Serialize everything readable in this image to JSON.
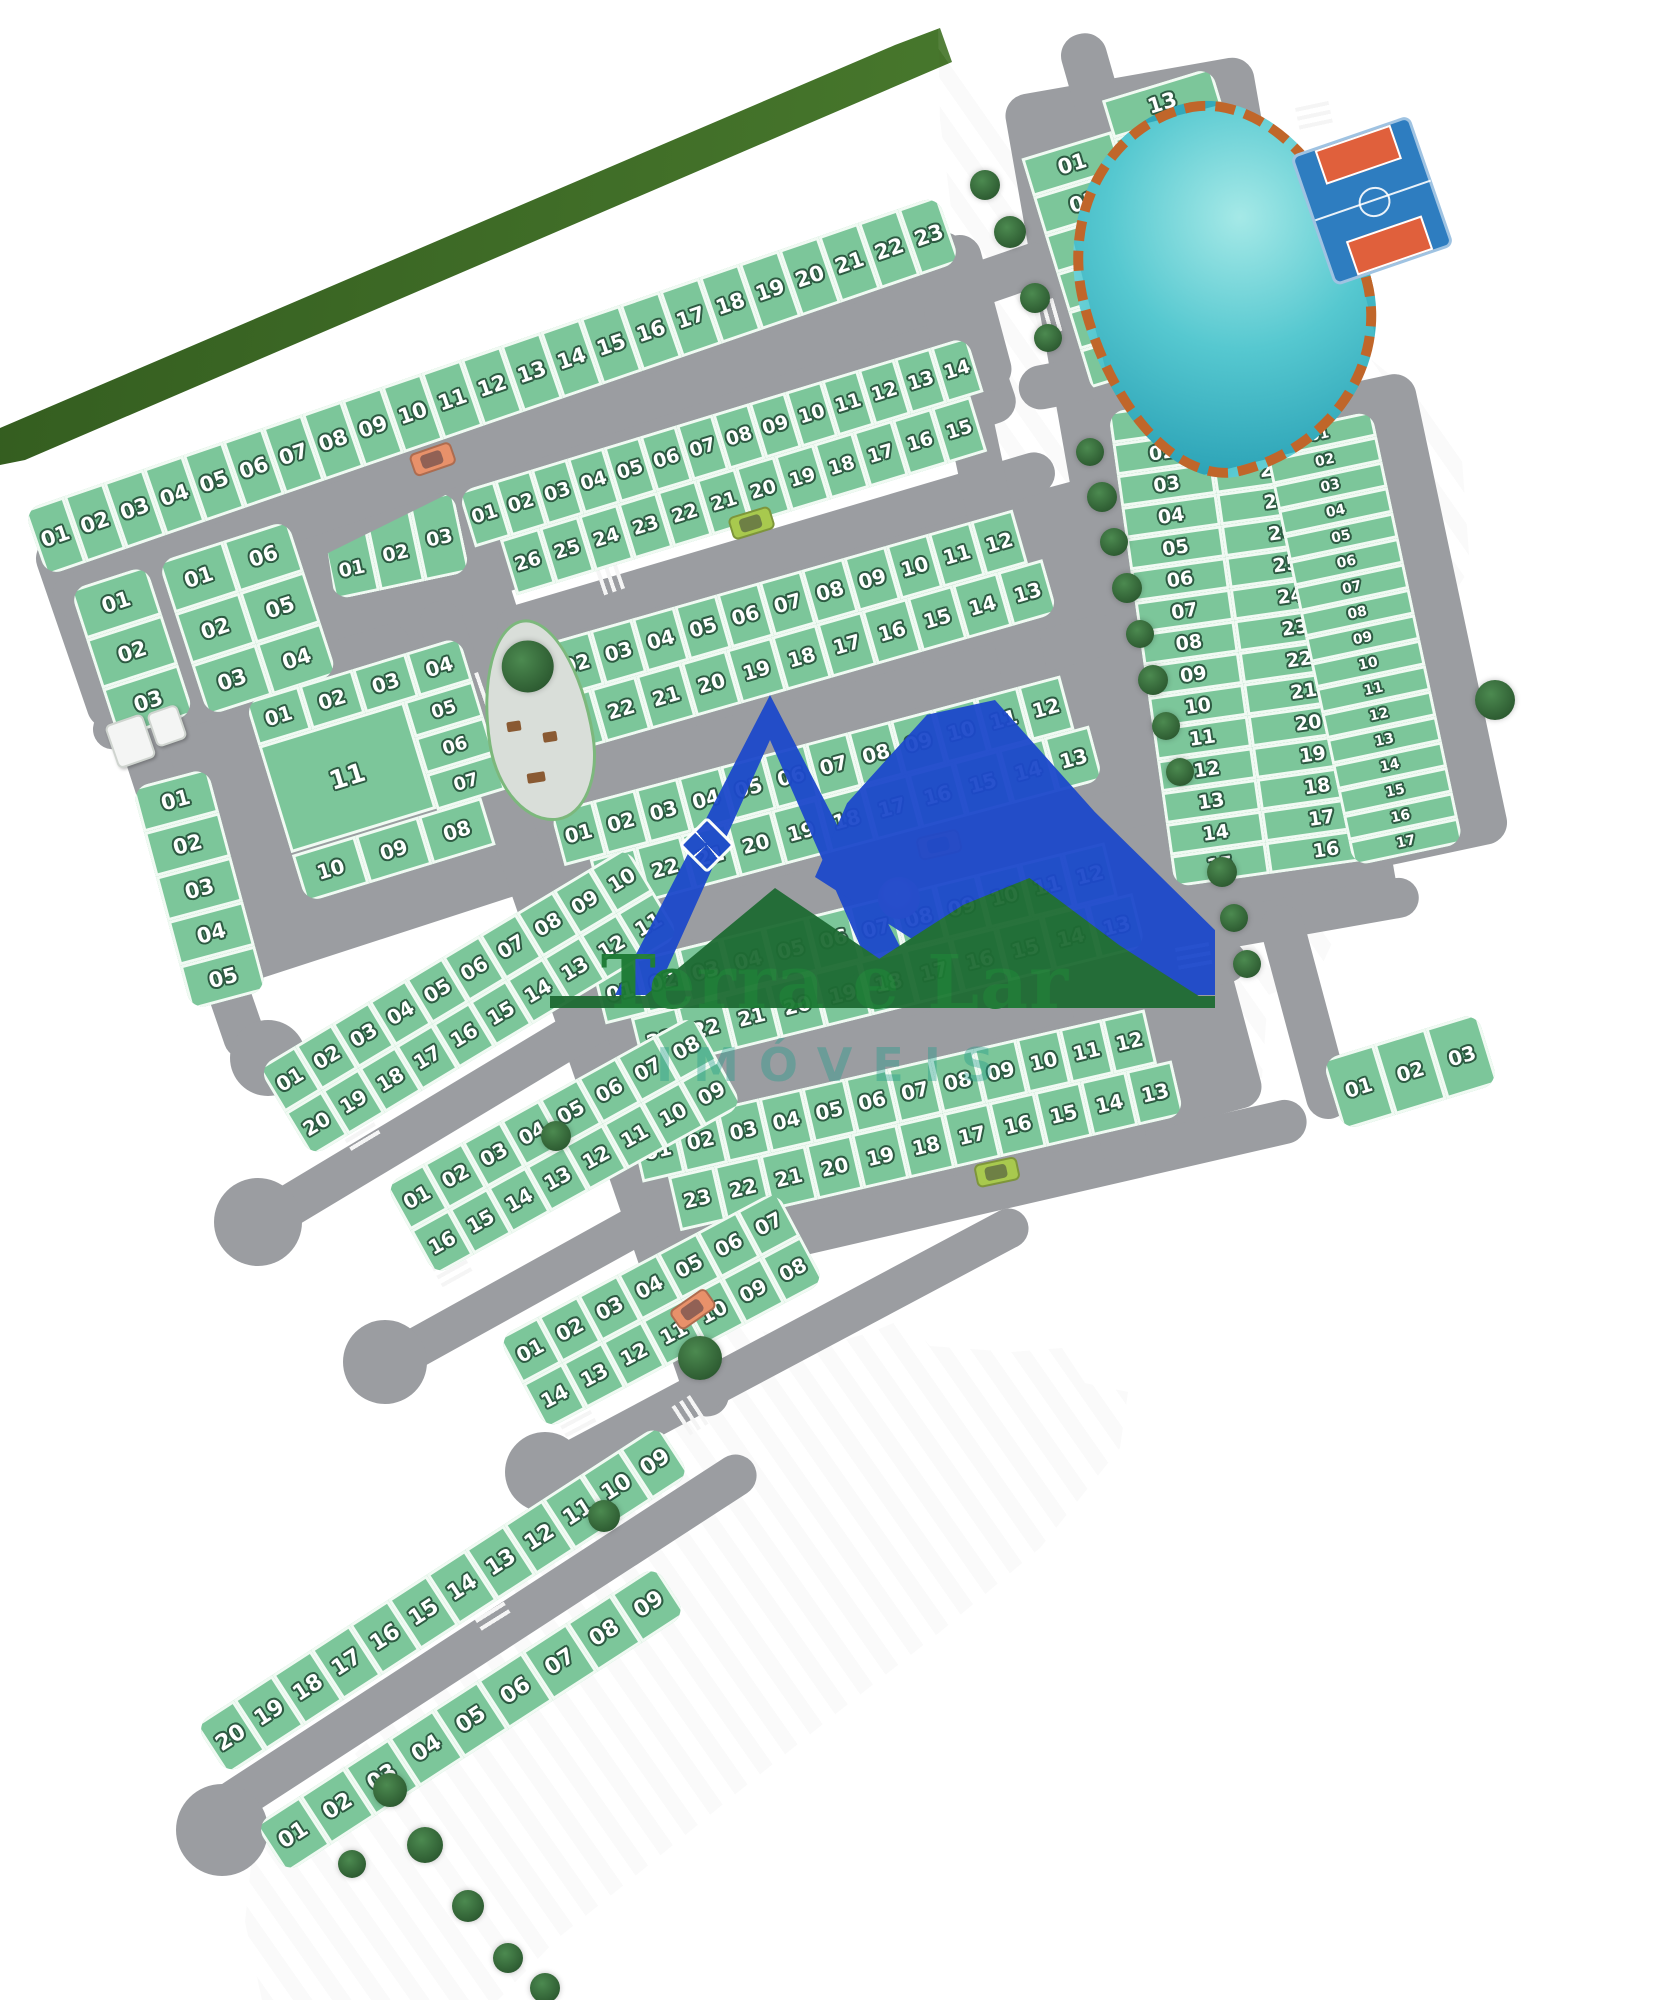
{
  "logo": {
    "title": "Terra e Lar",
    "subtitle": "IMÓVEIS"
  },
  "palette": {
    "lot_green": "#7CC69A",
    "road_gray": "#9B9DA1",
    "lake_teal": "#49BFCB",
    "path_orange": "#C0662A",
    "court_blue": "#2E7DC0",
    "logo_green": "#1C7A33",
    "logo_blue": "#1D49CB",
    "grass_light": "#A9C468",
    "grass_dark": "#3A6B26"
  },
  "map": {
    "blocks": [
      {
        "id": "strip-top",
        "type": "row",
        "lots": [
          "01",
          "02",
          "03",
          "04",
          "05",
          "06",
          "07",
          "08",
          "09",
          "10",
          "11",
          "12",
          "13",
          "14",
          "15",
          "16",
          "17",
          "18",
          "19",
          "20",
          "21",
          "22",
          "23"
        ]
      },
      {
        "id": "rb1",
        "type": "two-col",
        "cols": [
          [
            "01",
            "02",
            "03",
            "04",
            "05",
            "06"
          ],
          [
            "13",
            "12",
            "11",
            "10",
            "09",
            "08",
            "07"
          ]
        ]
      },
      {
        "id": "mb1",
        "type": "two-row",
        "top": [
          "01",
          "02",
          "03",
          "04",
          "05",
          "06",
          "07",
          "08",
          "09",
          "10",
          "11",
          "12",
          "13"
        ],
        "right": [
          "14"
        ],
        "bottom": [
          "26",
          "25",
          "24",
          "23",
          "22",
          "21",
          "20",
          "19",
          "18",
          "17",
          "16",
          "15"
        ]
      },
      {
        "id": "l1",
        "type": "col",
        "lots": [
          "01",
          "02",
          "03"
        ]
      },
      {
        "id": "l2",
        "type": "two-col",
        "cols": [
          [
            "01",
            "02",
            "03"
          ],
          [
            "06",
            "05",
            "04"
          ]
        ]
      },
      {
        "id": "tri",
        "type": "fan",
        "lots": [
          "01",
          "02",
          "03"
        ]
      },
      {
        "id": "block11",
        "type": "ring",
        "top": [
          "01",
          "02",
          "03",
          "04"
        ],
        "big": "11",
        "side": [
          "05",
          "06",
          "07"
        ],
        "bottom": [
          "10",
          "09",
          "08"
        ]
      },
      {
        "id": "lcolB",
        "type": "col",
        "lots": [
          "01",
          "02",
          "03",
          "04",
          "05"
        ]
      },
      {
        "id": "mb2",
        "type": "two-row",
        "top": [
          "01",
          "02",
          "03",
          "04",
          "05",
          "06",
          "07",
          "08",
          "09",
          "10",
          "11"
        ],
        "right": [
          "12"
        ],
        "bottom": [
          "23",
          "22",
          "21",
          "20",
          "19",
          "18",
          "17",
          "16",
          "15",
          "14",
          "13"
        ]
      },
      {
        "id": "mb3",
        "type": "two-row",
        "top": [
          "01",
          "02",
          "03",
          "04",
          "05",
          "06",
          "07",
          "08",
          "09",
          "10",
          "11"
        ],
        "right": [
          "12"
        ],
        "bottom": [
          "23",
          "22",
          "21",
          "20",
          "19",
          "18",
          "17",
          "16",
          "15",
          "14",
          "13"
        ]
      },
      {
        "id": "mb4",
        "type": "two-row",
        "top": [
          "01",
          "02",
          "03",
          "04",
          "05",
          "06",
          "07",
          "08",
          "09",
          "10",
          "11"
        ],
        "right": [
          "12"
        ],
        "bottom": [
          "23",
          "22",
          "21",
          "20",
          "19",
          "18",
          "17",
          "16",
          "15",
          "14",
          "13"
        ]
      },
      {
        "id": "mb5",
        "type": "two-row",
        "top": [
          "01",
          "02",
          "03",
          "04",
          "05",
          "06",
          "07",
          "08",
          "09",
          "10",
          "11"
        ],
        "right": [
          "12"
        ],
        "bottom": [
          "23",
          "22",
          "21",
          "20",
          "19",
          "18",
          "17",
          "16",
          "15",
          "14",
          "13"
        ]
      },
      {
        "id": "sa",
        "type": "two-row",
        "top": [
          "01",
          "02",
          "03",
          "04",
          "05",
          "06",
          "07",
          "08",
          "09",
          "10"
        ],
        "bottom": [
          "20",
          "19",
          "18",
          "17",
          "16",
          "15",
          "14",
          "13",
          "12",
          "11"
        ]
      },
      {
        "id": "sb",
        "type": "two-row",
        "top": [
          "01",
          "02",
          "03",
          "04",
          "05",
          "06",
          "07",
          "08"
        ],
        "bottom": [
          "16",
          "15",
          "14",
          "13",
          "12",
          "11",
          "10",
          "09"
        ]
      },
      {
        "id": "sc",
        "type": "two-row",
        "top": [
          "01",
          "02",
          "03",
          "04",
          "05",
          "06",
          "07"
        ],
        "bottom": [
          "14",
          "13",
          "12",
          "11",
          "10",
          "09",
          "08"
        ]
      },
      {
        "id": "sd1",
        "type": "row",
        "lots": [
          "20",
          "19",
          "18",
          "17",
          "16",
          "15",
          "14",
          "13",
          "12",
          "11",
          "10",
          "09"
        ]
      },
      {
        "id": "sd2",
        "type": "row",
        "lots": [
          "01",
          "02",
          "03",
          "04",
          "05",
          "06",
          "07",
          "08",
          "09"
        ]
      },
      {
        "id": "rb2",
        "type": "two-col",
        "cols": [
          [
            "01",
            "02",
            "03",
            "04",
            "05",
            "06",
            "07",
            "08",
            "09",
            "10",
            "11",
            "12",
            "13",
            "14",
            "15"
          ],
          [
            "30",
            "29",
            "28",
            "27",
            "26",
            "25",
            "24",
            "23",
            "22",
            "21",
            "20",
            "19",
            "18",
            "17",
            "16"
          ]
        ]
      },
      {
        "id": "rc",
        "type": "col",
        "lots": [
          "01",
          "02",
          "03",
          "04",
          "05",
          "06",
          "07",
          "08",
          "09",
          "10",
          "11",
          "12",
          "13",
          "14",
          "15",
          "16",
          "17"
        ]
      },
      {
        "id": "br",
        "type": "row",
        "lots": [
          "01",
          "02",
          "03"
        ]
      }
    ]
  }
}
